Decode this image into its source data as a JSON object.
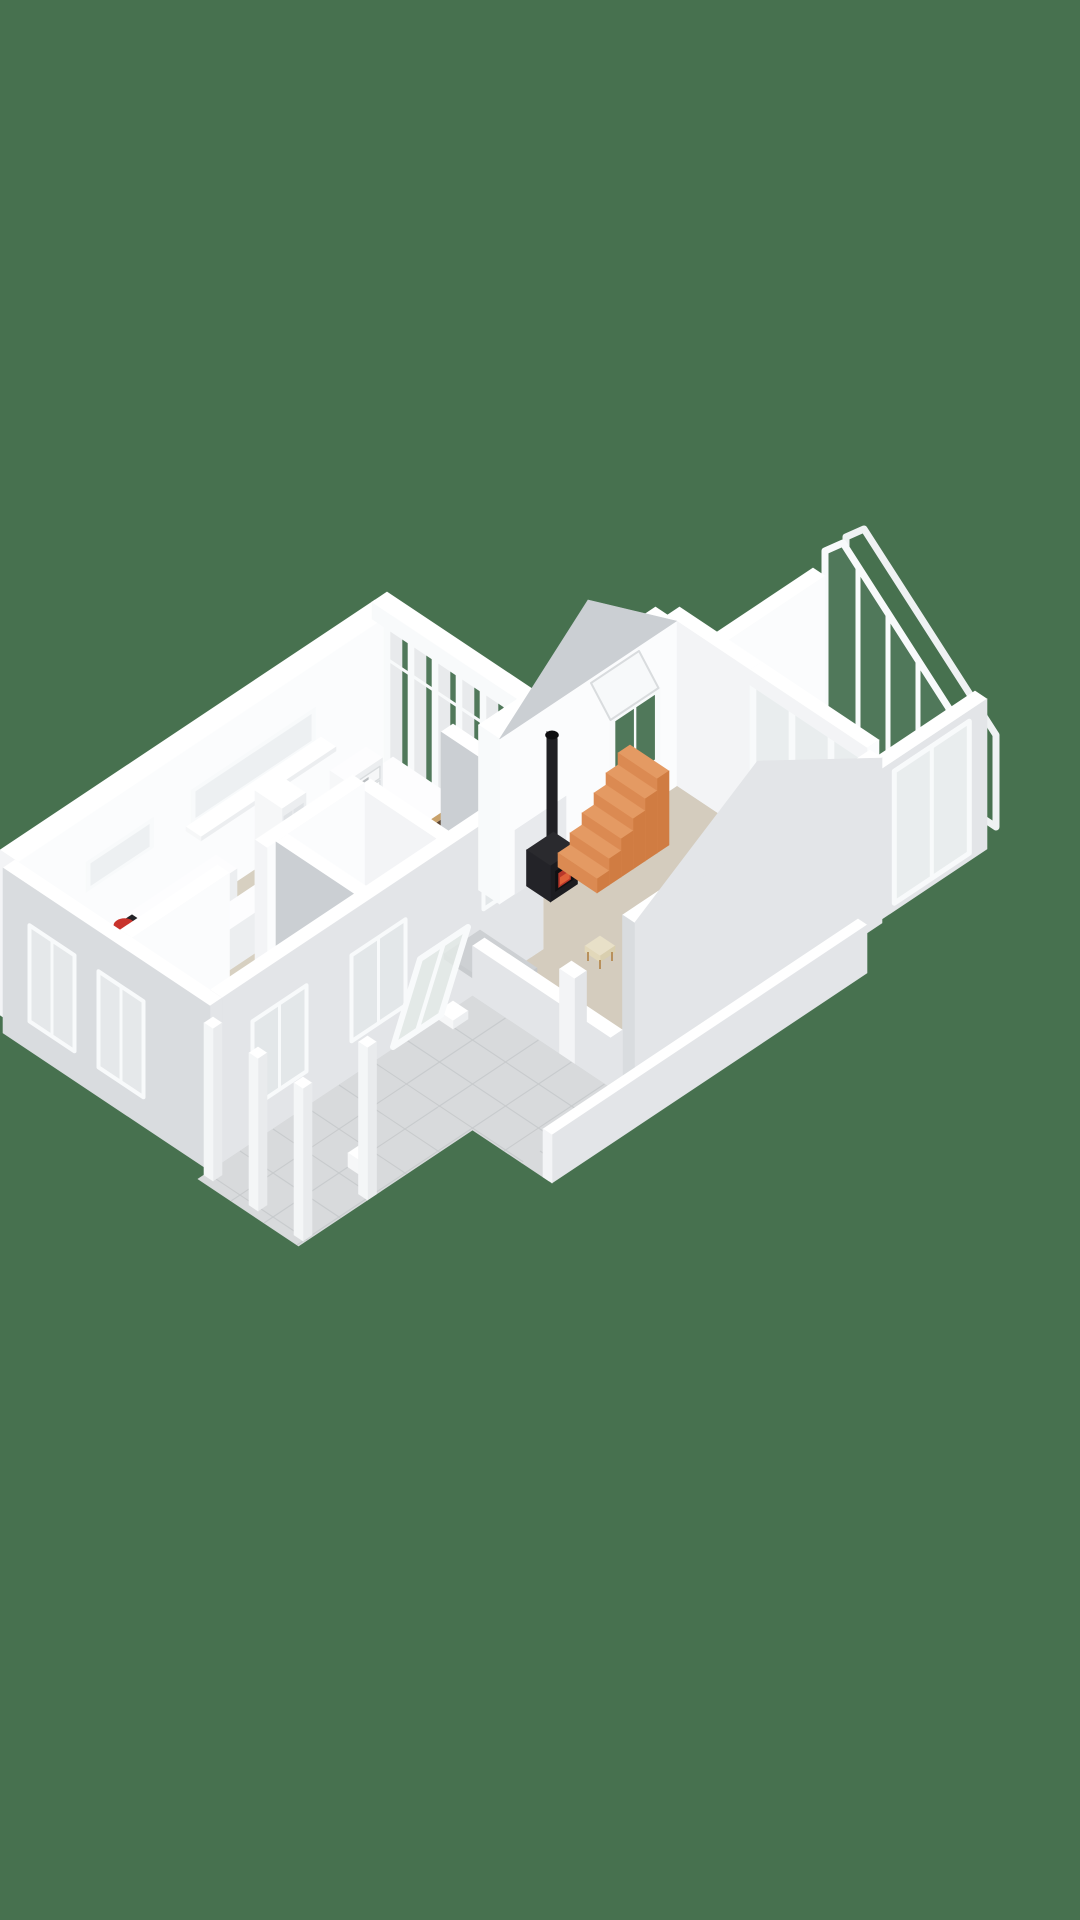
{
  "scene": {
    "background": "#47714F",
    "colors": {
      "wall_top": "#FFFFFF",
      "wall_bright": "#FBFCFD",
      "wall_light": "#F3F4F6",
      "wall_mid": "#E3E5E8",
      "wall_dim": "#D9DCDF",
      "wall_gray": "#CBCFD3",
      "floor_main": "#D7D0C1",
      "floor_bedroom": "#CFC7B8",
      "floor_hall": "#D3CCBD",
      "floor_bath": "#DAD4C8",
      "floor_living": "#D4CCBE",
      "terrace_tile": "#D8DADC",
      "terrace_grout": "#C7CACC",
      "conservatory_tile": "#EDEEEF",
      "conservatory_grout": "#DFE1E3",
      "glass_green": "#50785A",
      "glass_pale": "#E9EDEE",
      "frame": "#F8FAFB",
      "wood_light": "#C9A26B",
      "wood_mid": "#B8905C",
      "walnut": "#5E4733",
      "walnut_dark": "#4A3726",
      "stair_top": "#E49A63",
      "stair_side": "#D07C42",
      "stair_front": "#DB8A52",
      "stove_black": "#1C1C20",
      "stove_top": "#2A2A2E",
      "stove_dark": "#101013",
      "fire_red": "#B9382A",
      "fire_orange": "#E06038",
      "cooktop": "#232327",
      "burner": "#C8332C",
      "metal": "#9CA1A5",
      "fabric": "#CDD0D3",
      "cream": "#E8E0C8",
      "furn_top": "#FDFDFE",
      "furn_side_u": "#ECEEF0",
      "furn_side_v": "#F6F7F8",
      "pane_inset": "#EDF0F2",
      "cell_inset": "#DFE2E5"
    },
    "rooms": [
      "kitchen",
      "dining-area",
      "hallway",
      "bedroom",
      "bathroom",
      "living-room",
      "conservatory",
      "terrace",
      "porch"
    ],
    "objects": [
      "kitchen-counter",
      "induction-cooktop",
      "kitchen-island",
      "kitchen-sink",
      "cube-shelf",
      "dining-table",
      "dining-bench",
      "dining-chair",
      "drawer-unit",
      "wicker-stool",
      "sideboard",
      "book-rack",
      "bed",
      "dresser",
      "bathtub",
      "wash-basin",
      "wood-stove",
      "stove-pipe",
      "staircase",
      "rug",
      "awning-window",
      "ribbon-window",
      "french-doors",
      "glass-wall",
      "conservatory-glass-wall",
      "terrace-post",
      "parapet-wall",
      "leaning-glass-door"
    ]
  }
}
